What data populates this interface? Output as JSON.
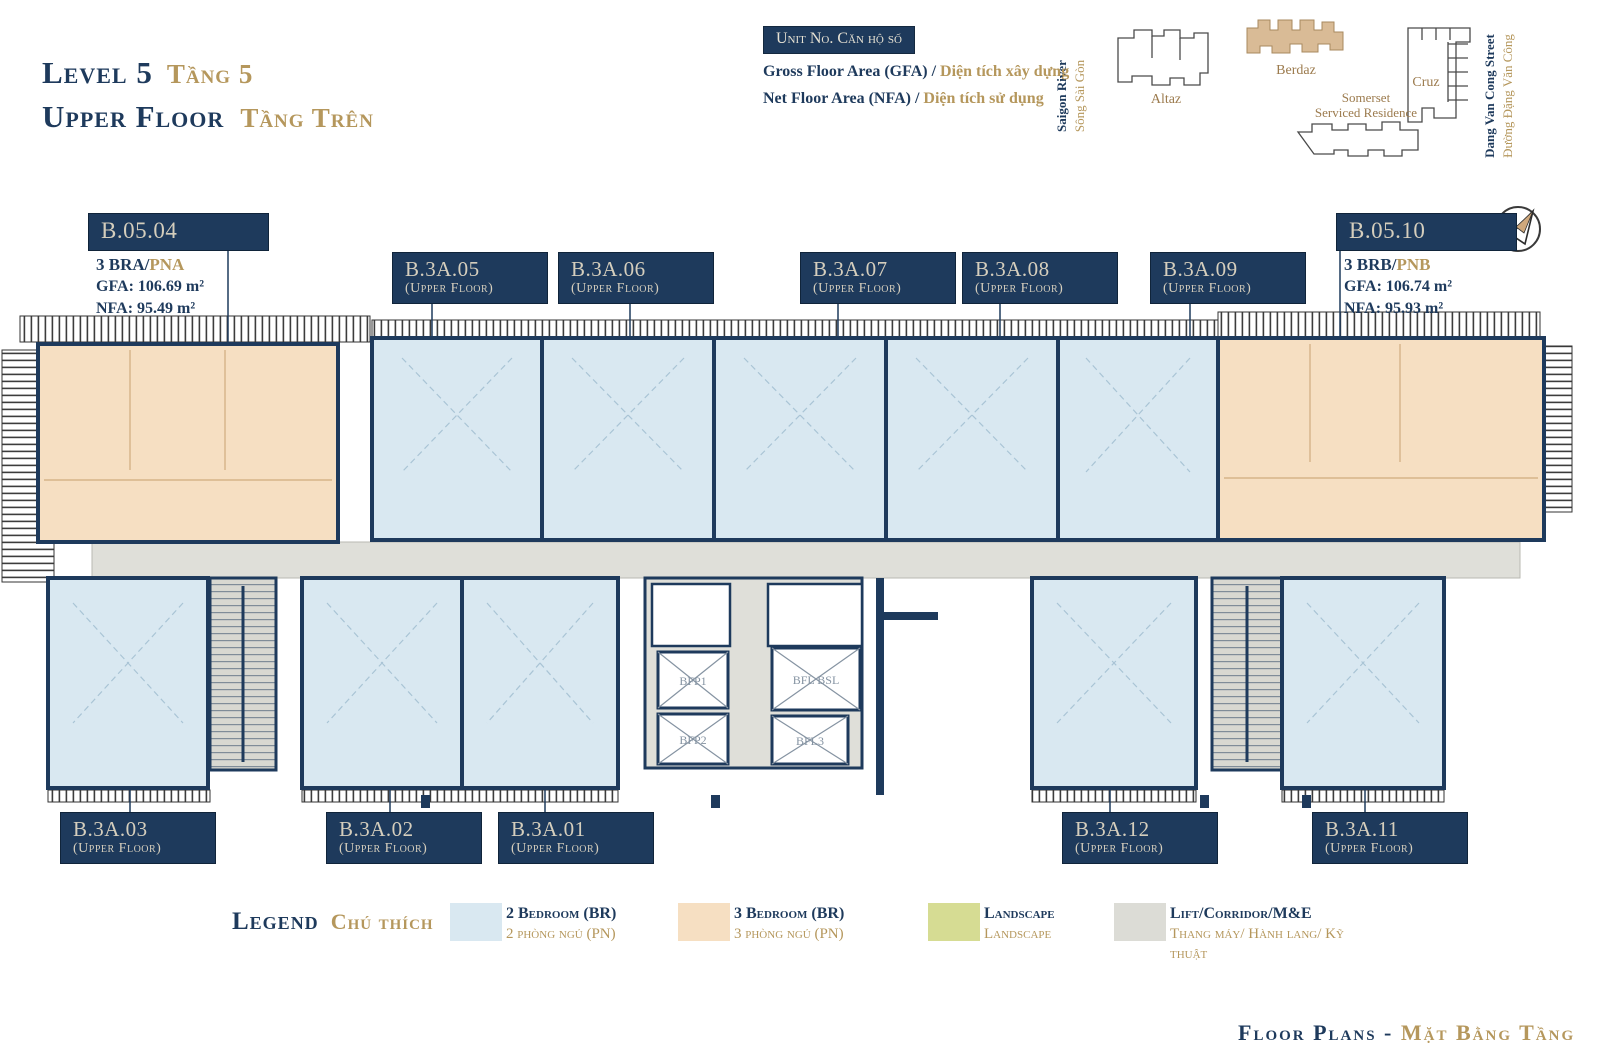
{
  "header": {
    "level_en": "Level 5",
    "level_vi": "Tầng 5",
    "floor_en": "Upper Floor",
    "floor_vi": "Tầng Trên"
  },
  "unit_key": {
    "unit_no": "Unit No.  Căn hộ số",
    "gfa_en": "Gross Floor Area (GFA) /",
    "gfa_vi": "Diện tích xây dựng",
    "nfa_en": "Net Floor Area (NFA) /",
    "nfa_vi": "Diện tích sử dụng"
  },
  "site_plan": {
    "river_en": "Saigon River",
    "river_vi": "Sông Sài Gòn",
    "altaz": "Altaz",
    "berdaz": "Berdaz",
    "cruz": "Cruz",
    "somerset_line1": "Somerset",
    "somerset_line2": "Serviced Residence",
    "street_en": "Dang Van Cong Street",
    "street_vi": "Đường Đặng Văn Công"
  },
  "units": {
    "b0504": {
      "id": "B.05.04",
      "type_en": "3 BRA/",
      "type_vi": "PNA",
      "gfa": "GFA: 106.69 m²",
      "nfa": "NFA: 95.49 m²"
    },
    "b0510": {
      "id": "B.05.10",
      "type_en": "3 BRB/",
      "type_vi": "PNB",
      "gfa": "GFA: 106.74 m²",
      "nfa": "NFA: 95.93 m²"
    },
    "b3a05": {
      "id": "B.3A.05",
      "floor": "(Upper Floor)"
    },
    "b3a06": {
      "id": "B.3A.06",
      "floor": "(Upper Floor)"
    },
    "b3a07": {
      "id": "B.3A.07",
      "floor": "(Upper Floor)"
    },
    "b3a08": {
      "id": "B.3A.08",
      "floor": "(Upper Floor)"
    },
    "b3a09": {
      "id": "B.3A.09",
      "floor": "(Upper Floor)"
    },
    "b3a03": {
      "id": "B.3A.03",
      "floor": "(Upper Floor)"
    },
    "b3a02": {
      "id": "B.3A.02",
      "floor": "(Upper Floor)"
    },
    "b3a01": {
      "id": "B.3A.01",
      "floor": "(Upper Floor)"
    },
    "b3a12": {
      "id": "B.3A.12",
      "floor": "(Upper Floor)"
    },
    "b3a11": {
      "id": "B.3A.11",
      "floor": "(Upper Floor)"
    }
  },
  "lifts": {
    "lift1": "BFP1",
    "lift2": "BFP2",
    "lift3": "BFL BSL",
    "lift4": "BFL3"
  },
  "legend": {
    "title_en": "Legend",
    "title_vi": "Chú thích",
    "items": [
      {
        "en": "2 Bedroom (BR)",
        "vi": "2 phòng ngủ (PN)",
        "color": "#d9e8f1"
      },
      {
        "en": "3 Bedroom (BR)",
        "vi": "3 phòng ngủ (PN)",
        "color": "#f6dfc2"
      },
      {
        "en": "Landscape",
        "vi": "Landscape",
        "color": "#d6dc93"
      },
      {
        "en": "Lift/Corridor/M&E",
        "vi": "Thang máy/ Hành lang/ Kỹ thuật",
        "color": "#dcdcd6"
      }
    ]
  },
  "footer": {
    "en": "Floor Plans -",
    "vi": "Mặt Bằng Tầng"
  },
  "colors": {
    "navy": "#1e3a5c",
    "gold": "#b5975c",
    "blue_2br": "#d9e8f1",
    "peach_3br": "#f6dfc2",
    "landscape": "#d6dc93",
    "corridor": "#dfdfd9"
  }
}
